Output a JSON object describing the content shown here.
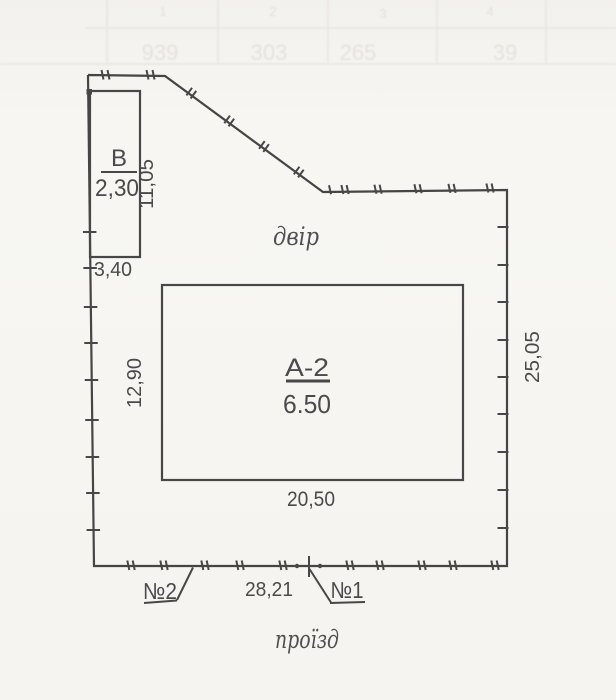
{
  "plan": {
    "areas": {
      "yard": "двір",
      "passage": "проїзд"
    },
    "buildings": {
      "main": {
        "label": "А-2",
        "mark": "6.50"
      },
      "annex": {
        "label": "В",
        "mark": "2,30"
      }
    },
    "dimensions": {
      "annex_side": "11,05",
      "annex_width": "3,40",
      "main_left_side": "12,90",
      "main_bottom_side": "20,50",
      "plot_right_side": "25,05",
      "plot_bottom_side": "28,21"
    },
    "markers": {
      "house1": "№1",
      "house2": "№2"
    }
  },
  "bleed_through": {
    "headers": [
      "1",
      "2",
      "3",
      "4"
    ],
    "values": [
      "939",
      "303",
      "265",
      "39"
    ]
  }
}
